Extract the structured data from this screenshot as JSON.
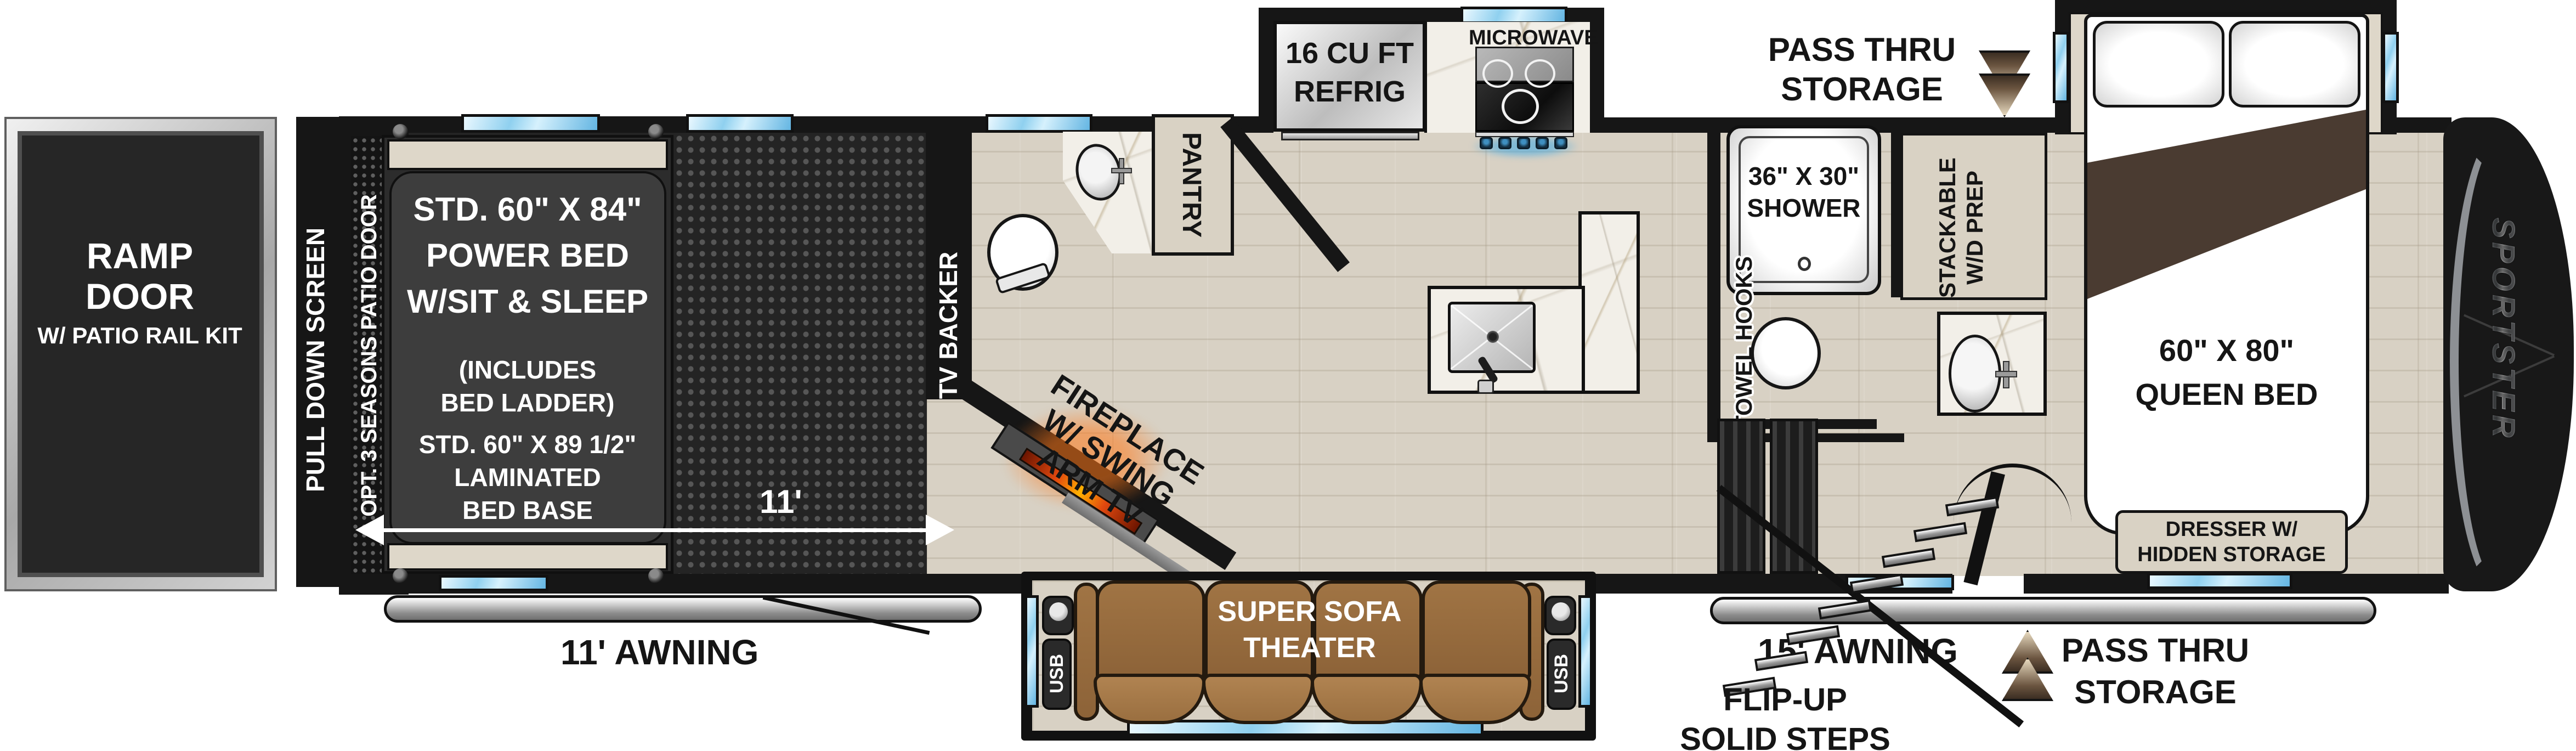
{
  "title": "Fifth wheel toy hauler floor plan",
  "logo": "SPORTSTER",
  "garage": {
    "ramp_door": [
      "RAMP DOOR",
      "W/ PATIO RAIL KIT"
    ],
    "pull_down_screen": "PULL DOWN SCREEN",
    "patio_door_option": "OPT. 3 SEASONS PATIO DOOR",
    "power_bed_lines": [
      "STD. 60\" X 84\"",
      "POWER BED",
      "W/SIT & SLEEP",
      "(INCLUDES",
      "BED LADDER)",
      "STD. 60\" X 89 1/2\"",
      "LAMINATED",
      "BED BASE"
    ],
    "dimension": "11'",
    "awning": "11' AWNING",
    "tv_backer": "TV BACKER"
  },
  "living": {
    "fireplace_lines": [
      "FIREPLACE",
      "W/ SWING",
      "ARM TV"
    ],
    "pantry": "PANTRY",
    "sofa_lines": [
      "SUPER SOFA",
      "THEATER"
    ],
    "usb": "USB"
  },
  "kitchen": {
    "refrigerator_lines": [
      "16 CU FT",
      "REFRIG"
    ],
    "microwave": "MICROWAVE"
  },
  "bath": {
    "shower_lines": [
      "36\" X 30\"",
      "SHOWER"
    ],
    "towel_hooks": "TOWEL HOOKS",
    "wd_prep_lines": [
      "STACKABLE",
      "W/D PREP"
    ]
  },
  "bedroom": {
    "queen_bed_lines": [
      "60\" X 80\"",
      "QUEEN BED"
    ],
    "dresser_lines": [
      "DRESSER W/",
      "HIDDEN STORAGE"
    ]
  },
  "exterior": {
    "pass_thru_top_lines": [
      "PASS THRU",
      "STORAGE"
    ],
    "pass_thru_bottom_lines": [
      "PASS THRU",
      "STORAGE"
    ],
    "awning_15": "15' AWNING",
    "flip_up_lines": [
      "FLIP-UP",
      "SOLID STEPS"
    ]
  },
  "colors": {
    "wall": "#161616",
    "wood_floor": "#d8d1c4",
    "garage_floor": "#242424",
    "window_blue": "#8fd0ef",
    "sofa_brown": "#9a6f40",
    "cabinet_tan": "#d9d2c4",
    "flame_orange": "#e2490f",
    "chrome": "#cdd1d5"
  }
}
